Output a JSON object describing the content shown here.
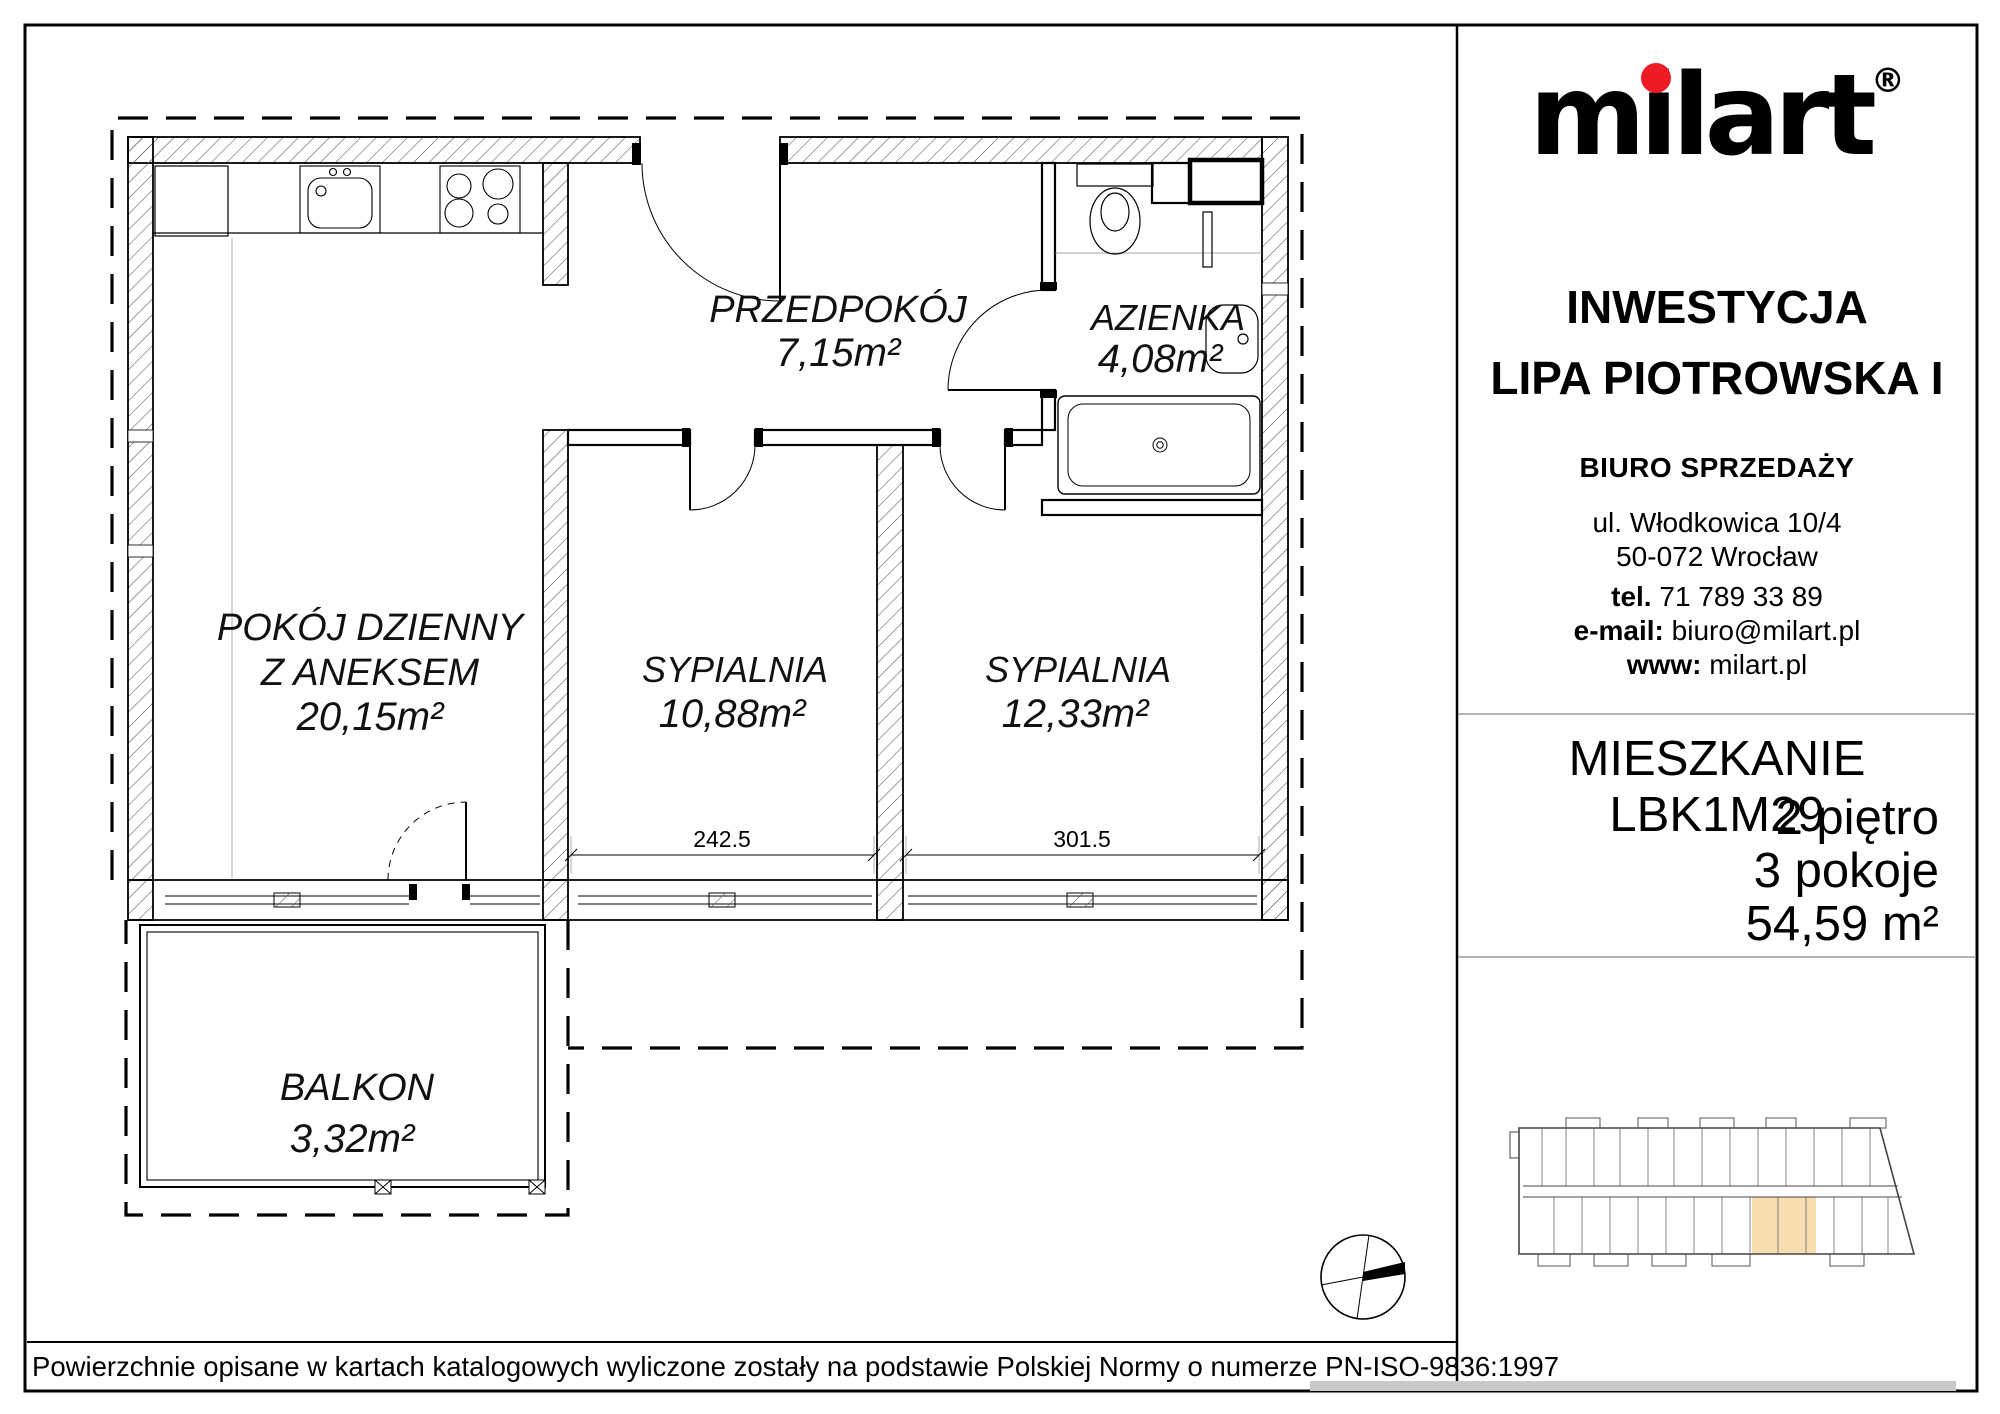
{
  "brand": {
    "logo_m": "m",
    "logo_i": "i",
    "logo_rest": "lart",
    "logo_text": "milart",
    "registered_mark": "®"
  },
  "sidebar": {
    "investment_label": "INWESTYCJA",
    "investment_name": "LIPA PIOTROWSKA I",
    "office_title": "BIURO SPRZEDAŻY",
    "address_line1": "ul. Włodkowica 10/4",
    "address_line2": "50-072 Wrocław",
    "phone_label": "tel.",
    "phone": " 71 789 33 89",
    "email_label": "e-mail:",
    "email": " biuro@milart.pl",
    "www_label": "www:",
    "www": " milart.pl",
    "apartment_title": "MIESZKANIE LBK1M29",
    "apartment_floor": "2 piętro",
    "apartment_rooms": "3 pokoje",
    "apartment_area": "54,59 m²"
  },
  "plan": {
    "rooms": {
      "living": {
        "name_line1": "POKÓJ  DZIENNY",
        "name_line2": "Z  ANEKSEM",
        "area": "20,15m²"
      },
      "hall": {
        "name": "PRZEDPOKÓJ",
        "area": "7,15m²"
      },
      "bath": {
        "name": "AZIENKA",
        "area": "4,08m²"
      },
      "bedroom1": {
        "name": "SYPIALNIA",
        "area": "10,88m²"
      },
      "bedroom2": {
        "name": "SYPIALNIA",
        "area": "12,33m²"
      },
      "balcony": {
        "name": "BALKON",
        "area": "3,32m²"
      }
    },
    "dimensions": {
      "bedroom1_width": "242.5",
      "bedroom2_width": "301.5"
    }
  },
  "colors": {
    "brand_red": "#ed1c24",
    "minimap_highlight": "#f8ddb0"
  },
  "footer": {
    "disclaimer": "Powierzchnie opisane w kartach katalogowych wyliczone zostały na podstawie  Polskiej Normy o numerze PN-ISO-9836:1997"
  }
}
